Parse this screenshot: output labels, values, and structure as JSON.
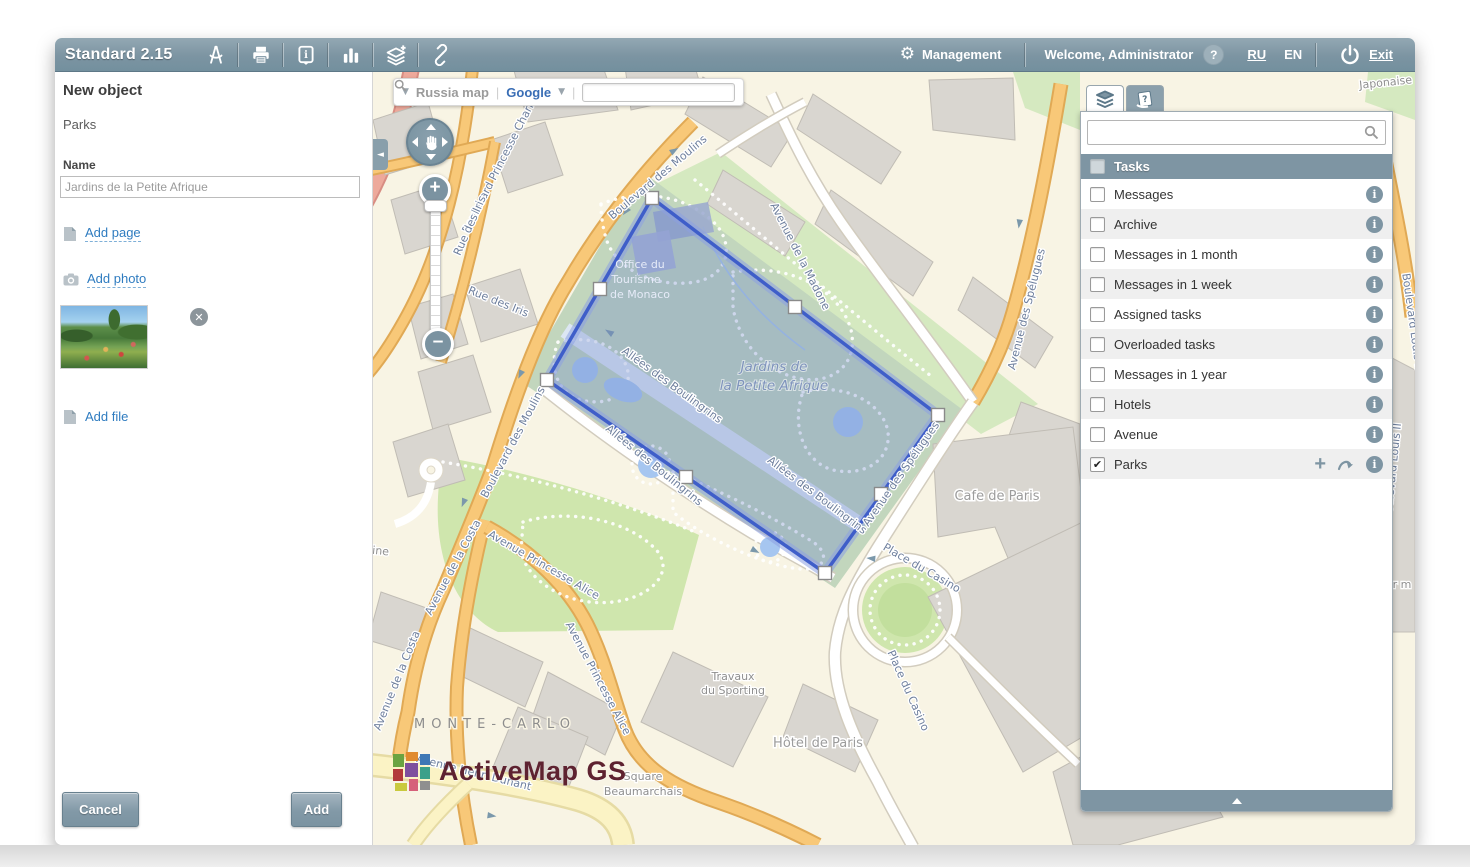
{
  "titlebar": {
    "title": "Standard 2.15",
    "management": "Management",
    "welcome": "Welcome, Administrator",
    "help_badge": "?",
    "lang_ru": "RU",
    "lang_en": "EN",
    "exit": "Exit"
  },
  "left_panel": {
    "heading": "New object",
    "layer_name": "Parks",
    "name_label": "Name",
    "name_value": "Jardins de la Petite Afrique",
    "add_page": "Add page",
    "add_photo": "Add photo",
    "add_file": "Add file",
    "cancel_button": "Cancel",
    "add_button": "Add"
  },
  "map_toolbar": {
    "map_select": "Russia map",
    "provider_select": "Google",
    "separator": "|",
    "search_value": ""
  },
  "right_panel": {
    "group_label": "Tasks",
    "search_value": "",
    "tasks": [
      {
        "label": "Messages",
        "checked": false
      },
      {
        "label": "Archive",
        "checked": false
      },
      {
        "label": "Messages in 1 month",
        "checked": false
      },
      {
        "label": "Messages in 1 week",
        "checked": false
      },
      {
        "label": "Assigned tasks",
        "checked": false
      },
      {
        "label": "Overloaded tasks",
        "checked": false
      },
      {
        "label": "Messages in 1 year",
        "checked": false
      },
      {
        "label": "Hotels",
        "checked": false
      },
      {
        "label": "Avenue",
        "checked": false
      },
      {
        "label": "Parks",
        "checked": true,
        "actions": [
          "add-object",
          "reply-arrow"
        ]
      }
    ]
  },
  "map": {
    "logo_text": "ActiveMap GS",
    "selected_object": "Jardins de la Petite Afrique",
    "labels": [
      {
        "t": "Boulevard Princesse Charlotte",
        "x": 133,
        "y": 88,
        "r": -63,
        "c": "st"
      },
      {
        "t": "Rue des Iris",
        "x": 100,
        "y": 155,
        "r": -66,
        "c": "st"
      },
      {
        "t": "Rue des Iris",
        "x": 124,
        "y": 233,
        "r": 22,
        "c": "st"
      },
      {
        "t": "Boulevard des Moulins",
        "x": 287,
        "y": 108,
        "r": -40,
        "c": "st"
      },
      {
        "t": "Boulevard des Moulins",
        "x": 143,
        "y": 372,
        "r": -62,
        "c": "st"
      },
      {
        "t": "Avenue de la Madone",
        "x": 424,
        "y": 186,
        "r": 63,
        "c": "st"
      },
      {
        "t": "Avenue des Spélugues",
        "x": 657,
        "y": 238,
        "r": -76,
        "c": "st"
      },
      {
        "t": "Avenue des Spélugues",
        "x": 531,
        "y": 404,
        "r": -55,
        "c": "st"
      },
      {
        "t": "Allées des Boulingrins",
        "x": 297,
        "y": 316,
        "r": 36,
        "c": "st"
      },
      {
        "t": "Allées des Boulingrins",
        "x": 279,
        "y": 396,
        "r": 39,
        "c": "st"
      },
      {
        "t": "Allées des Boulingrins",
        "x": 442,
        "y": 426,
        "r": 37,
        "c": "st"
      },
      {
        "t": "Place du Casino",
        "x": 547,
        "y": 499,
        "r": 30,
        "c": "st"
      },
      {
        "t": "Place du Casino",
        "x": 532,
        "y": 620,
        "r": 66,
        "c": "st"
      },
      {
        "t": "Avenue de la Costa",
        "x": 83,
        "y": 497,
        "r": -62,
        "c": "st"
      },
      {
        "t": "Avenue de la Costa",
        "x": 27,
        "y": 610,
        "r": -68,
        "c": "st"
      },
      {
        "t": "Avenue Princesse Alice",
        "x": 169,
        "y": 496,
        "r": 30,
        "c": "st"
      },
      {
        "t": "Avenue Princesse Alice",
        "x": 222,
        "y": 608,
        "r": 62,
        "c": "st"
      },
      {
        "t": "Avenue Henri Dunant",
        "x": 100,
        "y": 704,
        "r": 14,
        "c": "st"
      },
      {
        "t": "Fontaine",
        "x": -8,
        "y": 481,
        "r": 6,
        "c": "pl"
      },
      {
        "t": "Japonaise",
        "x": 1013,
        "y": 14,
        "r": -6,
        "c": "pl"
      },
      {
        "t": "Boulevard Louis II",
        "x": 1036,
        "y": 250,
        "r": 82,
        "c": "st"
      },
      {
        "t": "Boulevard Louis II",
        "x": 1023,
        "y": 400,
        "r": -84,
        "c": "st"
      },
      {
        "t": "r m",
        "x": 1029,
        "y": 516,
        "r": 0,
        "c": "pl"
      },
      {
        "t": "MONTE-CARLO",
        "x": 122,
        "y": 656,
        "r": 0,
        "c": "city"
      },
      {
        "t": "Cafe de Paris",
        "x": 624,
        "y": 428,
        "r": 0,
        "c": "pl2"
      },
      {
        "t": "Hôtel de Paris",
        "x": 445,
        "y": 675,
        "r": 0,
        "c": "pl2"
      },
      {
        "t": "Travaux",
        "x": 360,
        "y": 608,
        "r": 0,
        "c": "pl"
      },
      {
        "t": "du Sporting",
        "x": 360,
        "y": 622,
        "r": 0,
        "c": "pl"
      },
      {
        "t": "Square",
        "x": 270,
        "y": 708,
        "r": 0,
        "c": "pl"
      },
      {
        "t": "Beaumarchais",
        "x": 270,
        "y": 723,
        "r": 0,
        "c": "pl"
      },
      {
        "t": "Office du",
        "x": 267,
        "y": 196,
        "r": 0,
        "c": "park2"
      },
      {
        "t": "Tourisme",
        "x": 263,
        "y": 211,
        "r": 0,
        "c": "park2"
      },
      {
        "t": "de Monaco",
        "x": 267,
        "y": 226,
        "r": 0,
        "c": "park2"
      },
      {
        "t": "Jardins de",
        "x": 401,
        "y": 299,
        "r": 0,
        "c": "park"
      },
      {
        "t": "la Petite Afrique",
        "x": 401,
        "y": 318,
        "r": 0,
        "c": "park"
      }
    ]
  },
  "colors": {
    "slate": "#7e95a3",
    "link_blue": "#2f7cc0",
    "polygon_stroke": "#3f5ec9",
    "logo_maroon": "#5e2230",
    "road_orange": "#f8c878",
    "park_green": "#cfe6ad"
  }
}
